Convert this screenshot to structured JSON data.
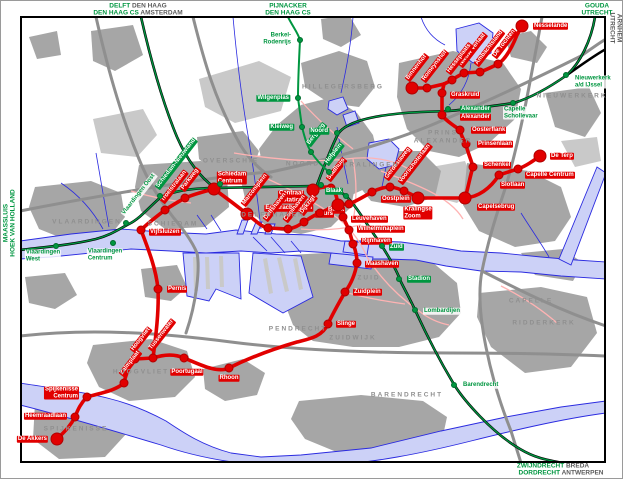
{
  "colors": {
    "metro_red": "#e10000",
    "rail_green": "#009640",
    "water_fill": "#ccd1f7",
    "water_line": "#2a2ae0",
    "motorway": "#8f8f8f",
    "urban": "#a6a6a6",
    "urban_light": "#c6c6c6",
    "tram_pink": "#ffb3b3",
    "area_text": "#8f8f8f",
    "edge_dark": "#5a5a5a"
  },
  "legend": {
    "metro_station": "metro-station",
    "rail_station": "rail-station"
  },
  "edge_labels": [
    {
      "id": "dest-delft-denhaag",
      "x": 137,
      "y": 5,
      "anchor": "middle",
      "rot": 0,
      "segs": [
        {
          "t": "DELFT ",
          "c": "g"
        },
        {
          "t": "DEN HAAG",
          "c": "d"
        }
      ]
    },
    {
      "id": "dest-denhaagcs-amsterdam",
      "x": 137,
      "y": 12,
      "anchor": "middle",
      "rot": 0,
      "segs": [
        {
          "t": "DEN HAAG CS ",
          "c": "g"
        },
        {
          "t": "AMSTERDAM",
          "c": "d"
        }
      ]
    },
    {
      "id": "dest-pijnacker",
      "x": 287,
      "y": 5,
      "anchor": "middle",
      "rot": 0,
      "segs": [
        {
          "t": "PIJNACKER",
          "c": "g"
        }
      ]
    },
    {
      "id": "dest-denhaagcs",
      "x": 287,
      "y": 12,
      "anchor": "middle",
      "rot": 0,
      "segs": [
        {
          "t": "DEN HAAG CS",
          "c": "g"
        }
      ]
    },
    {
      "id": "dest-gouda",
      "x": 596,
      "y": 5,
      "anchor": "middle",
      "rot": 0,
      "segs": [
        {
          "t": "GOUDA",
          "c": "g"
        }
      ]
    },
    {
      "id": "dest-utrecht-top",
      "x": 596,
      "y": 12,
      "anchor": "middle",
      "rot": 0,
      "segs": [
        {
          "t": "UTRECHT",
          "c": "g"
        }
      ]
    },
    {
      "id": "dest-utrecht-right",
      "x": 611,
      "y": 27,
      "anchor": "middle",
      "rot": 90,
      "segs": [
        {
          "t": "UTRECHT",
          "c": "d"
        }
      ]
    },
    {
      "id": "dest-arnhem-right",
      "x": 618,
      "y": 27,
      "anchor": "middle",
      "rot": 90,
      "segs": [
        {
          "t": "ARNHEM",
          "c": "d"
        }
      ]
    },
    {
      "id": "dest-maassluis",
      "x": 5,
      "y": 222,
      "anchor": "middle",
      "rot": -90,
      "segs": [
        {
          "t": "MAASSLUIS",
          "c": "g"
        }
      ]
    },
    {
      "id": "dest-hoekvanholland",
      "x": 12,
      "y": 222,
      "anchor": "middle",
      "rot": -90,
      "segs": [
        {
          "t": "HOEK VAN HOLLAND",
          "c": "g"
        }
      ]
    },
    {
      "id": "dest-zwijndrecht-breda",
      "x": 552,
      "y": 465,
      "anchor": "middle",
      "rot": 0,
      "segs": [
        {
          "t": "ZWIJNDRECHT ",
          "c": "g"
        },
        {
          "t": "BREDA",
          "c": "d"
        }
      ]
    },
    {
      "id": "dest-dordrecht-antwerpen",
      "x": 560,
      "y": 472,
      "anchor": "middle",
      "rot": 0,
      "segs": [
        {
          "t": "DORDRECHT ",
          "c": "g"
        },
        {
          "t": "ANTWERPEN",
          "c": "d"
        }
      ]
    }
  ],
  "areas": [
    {
      "name": "VLAARDINGEN",
      "x": 86,
      "y": 221
    },
    {
      "name": "SCHIEDAM",
      "x": 172,
      "y": 223
    },
    {
      "name": "OVERSCHIE",
      "x": 230,
      "y": 160
    },
    {
      "name": "NOORD",
      "x": 302,
      "y": 163
    },
    {
      "name": "HILLEGERSBERG",
      "x": 342,
      "y": 86
    },
    {
      "name": "KRALINGEN",
      "x": 370,
      "y": 164
    },
    {
      "name": "DELFSHAVEN",
      "x": 272,
      "y": 214
    },
    {
      "name": "PRINS\nALEXANDER",
      "x": 442,
      "y": 136
    },
    {
      "name": "NIEUWERKERK",
      "x": 571,
      "y": 95
    },
    {
      "name": "CAPELLE",
      "x": 530,
      "y": 300
    },
    {
      "name": "ZUID",
      "x": 368,
      "y": 277
    },
    {
      "name": "ZUIDWIJK",
      "x": 352,
      "y": 337
    },
    {
      "name": "PENDRECHT",
      "x": 297,
      "y": 328
    },
    {
      "name": "RIDDERKERK",
      "x": 543,
      "y": 322
    },
    {
      "name": "BARENDRECHT",
      "x": 406,
      "y": 394
    },
    {
      "name": "HOOGVLIET",
      "x": 140,
      "y": 371
    },
    {
      "name": "SPIJKENISSE",
      "x": 75,
      "y": 428
    }
  ],
  "metro_stations": [
    {
      "n": "Nesselande",
      "x": 521,
      "y": 25,
      "big": true,
      "lx": 532,
      "ly": 25,
      "a": "start"
    },
    {
      "n": "De Tochten",
      "x": 497,
      "y": 63,
      "lx": 493,
      "ly": 56,
      "a": "diag"
    },
    {
      "n": "Ambachtsland",
      "x": 479,
      "y": 71,
      "lx": 475,
      "ly": 64,
      "a": "diag"
    },
    {
      "n": "Nieuw Verlaat",
      "x": 463,
      "y": 72,
      "lx": 459,
      "ly": 65,
      "a": "diag"
    },
    {
      "n": "Hesseplaats",
      "x": 451,
      "y": 79,
      "lx": 447,
      "ly": 72,
      "a": "diag"
    },
    {
      "n": "Romeynshof",
      "x": 426,
      "y": 87,
      "lx": 422,
      "ly": 80,
      "a": "diag"
    },
    {
      "n": "Binnenhof",
      "x": 411,
      "y": 87,
      "big": true,
      "lx": 406,
      "ly": 79,
      "a": "diag"
    },
    {
      "n": "Graskruid",
      "x": 441,
      "y": 92,
      "lx": 449,
      "ly": 94,
      "a": "start"
    },
    {
      "n": "Alexander",
      "x": 441,
      "y": 114,
      "lx": 459,
      "ly": 116,
      "a": "start"
    },
    {
      "n": "Oosterflank",
      "x": 459,
      "y": 129,
      "lx": 470,
      "ly": 129,
      "a": "start"
    },
    {
      "n": "Prinsenlaan",
      "x": 465,
      "y": 143,
      "lx": 476,
      "ly": 143,
      "a": "start"
    },
    {
      "n": "Schenkel",
      "x": 472,
      "y": 166,
      "lx": 482,
      "ly": 164,
      "a": "start"
    },
    {
      "n": "Capelsebrug",
      "x": 464,
      "y": 197,
      "big": true,
      "lx": 476,
      "ly": 206,
      "a": "start"
    },
    {
      "n": "Slotlaan",
      "x": 498,
      "y": 174,
      "lx": 499,
      "ly": 184,
      "a": "start"
    },
    {
      "n": "Capelle Centrum",
      "x": 517,
      "y": 168,
      "lx": 524,
      "ly": 174,
      "a": "start"
    },
    {
      "n": "De Terp",
      "x": 539,
      "y": 155,
      "big": true,
      "lx": 549,
      "ly": 155,
      "a": "start"
    },
    {
      "n": "Kralingse\nZoom",
      "x": 417,
      "y": 197,
      "big": true,
      "lx": 417,
      "ly": 212,
      "a": "middle"
    },
    {
      "n": "Voorschoterlaan",
      "x": 403,
      "y": 190,
      "lx": 399,
      "ly": 182,
      "a": "diag"
    },
    {
      "n": "Gerdesiaweg",
      "x": 389,
      "y": 186,
      "lx": 385,
      "ly": 178,
      "a": "diag"
    },
    {
      "n": "Oostplein",
      "x": 371,
      "y": 191,
      "lx": 380,
      "ly": 198,
      "a": "start"
    },
    {
      "n": "Blaak",
      "x": 348,
      "y": 203,
      "lx": 344,
      "ly": 209,
      "a": "end"
    },
    {
      "n": "Beurs",
      "x": 337,
      "y": 204,
      "big": true,
      "lx": 333,
      "ly": 213,
      "a": "end"
    },
    {
      "n": "Stadhuis",
      "x": 330,
      "y": 187,
      "lx": 327,
      "ly": 179,
      "a": "diag"
    },
    {
      "n": "Centraal\nStation",
      "x": 312,
      "y": 189,
      "big": true,
      "lx": 303,
      "ly": 196,
      "a": "end",
      "align": "right"
    },
    {
      "n": "Eendrachtsplein",
      "x": 319,
      "y": 212,
      "lx": 312,
      "ly": 207,
      "a": "end"
    },
    {
      "n": "Dijkzigt",
      "x": 303,
      "y": 221,
      "lx": 300,
      "ly": 213,
      "a": "diag"
    },
    {
      "n": "Coolhaven",
      "x": 287,
      "y": 228,
      "lx": 284,
      "ly": 220,
      "a": "diag"
    },
    {
      "n": "Delfshaven",
      "x": 267,
      "y": 227,
      "lx": 264,
      "ly": 219,
      "a": "diag"
    },
    {
      "n": "Marconiplein",
      "x": 246,
      "y": 213,
      "big": true,
      "lx": 242,
      "ly": 204,
      "a": "diag"
    },
    {
      "n": "Leuvehaven",
      "x": 342,
      "y": 216,
      "lx": 350,
      "ly": 218,
      "a": "start"
    },
    {
      "n": "Wilhelminaplein",
      "x": 348,
      "y": 229,
      "lx": 356,
      "ly": 228,
      "a": "start"
    },
    {
      "n": "Rijnhaven",
      "x": 352,
      "y": 243,
      "lx": 360,
      "ly": 240,
      "a": "start"
    },
    {
      "n": "Maashaven",
      "x": 356,
      "y": 262,
      "lx": 364,
      "ly": 263,
      "a": "start"
    },
    {
      "n": "Zuidplein",
      "x": 344,
      "y": 291,
      "lx": 352,
      "ly": 291,
      "a": "start"
    },
    {
      "n": "Slinge",
      "x": 327,
      "y": 323,
      "lx": 335,
      "ly": 323,
      "a": "start"
    },
    {
      "n": "Rhoon",
      "x": 228,
      "y": 367,
      "lx": 228,
      "ly": 377,
      "a": "middle"
    },
    {
      "n": "Poortugaal",
      "x": 183,
      "y": 357,
      "lx": 186,
      "ly": 371,
      "a": "middle"
    },
    {
      "n": "Tussenwater",
      "x": 152,
      "y": 357,
      "lx": 149,
      "ly": 349,
      "a": "diag"
    },
    {
      "n": "Hoogvliet",
      "x": 134,
      "y": 358,
      "lx": 131,
      "ly": 350,
      "a": "diag"
    },
    {
      "n": "Zalmplaat",
      "x": 123,
      "y": 382,
      "lx": 120,
      "ly": 374,
      "a": "diag"
    },
    {
      "n": "Spijkenisse\nCentrum",
      "x": 86,
      "y": 396,
      "lx": 78,
      "ly": 392,
      "a": "end",
      "align": "right"
    },
    {
      "n": "Heemraadlaan",
      "x": 74,
      "y": 416,
      "lx": 66,
      "ly": 415,
      "a": "end"
    },
    {
      "n": "De Akkers",
      "x": 56,
      "y": 438,
      "big": true,
      "lx": 47,
      "ly": 438,
      "a": "end"
    },
    {
      "n": "Pernis",
      "x": 157,
      "y": 288,
      "lx": 166,
      "ly": 288,
      "a": "start"
    },
    {
      "n": "Vijfsluizen",
      "x": 140,
      "y": 229,
      "lx": 148,
      "ly": 231,
      "a": "start"
    },
    {
      "n": "Troelstralaan",
      "x": 164,
      "y": 209,
      "lx": 161,
      "ly": 201,
      "a": "diag"
    },
    {
      "n": "Parkweg",
      "x": 184,
      "y": 197,
      "lx": 181,
      "ly": 189,
      "a": "diag"
    },
    {
      "n": "Schiedam\nCentrum",
      "x": 213,
      "y": 188,
      "big": true,
      "lx": 231,
      "ly": 177,
      "a": "middle"
    }
  ],
  "rail_stations": [
    {
      "n": "Berkel-\nRodenrijs",
      "x": 299,
      "y": 39,
      "style": "greentext",
      "lx": 291,
      "ly": 38,
      "a": "end",
      "align": "right"
    },
    {
      "n": "Wilgenplas",
      "x": 297,
      "y": 97,
      "style": "greenfill",
      "lx": 289,
      "ly": 97,
      "a": "end"
    },
    {
      "n": "Kleiweg",
      "x": 301,
      "y": 126,
      "style": "greenfill",
      "lx": 293,
      "ly": 126,
      "a": "end"
    },
    {
      "n": "Bergweg",
      "x": 310,
      "y": 151,
      "style": "greenfill",
      "lx": 307,
      "ly": 144,
      "a": "diag"
    },
    {
      "n": "Hofplein",
      "x": 328,
      "y": 171,
      "style": "greenfill",
      "lx": 325,
      "ly": 163,
      "a": "diag"
    },
    {
      "n": "Noord",
      "x": 336,
      "y": 132,
      "style": "greenfill",
      "lx": 328,
      "ly": 130,
      "a": "end"
    },
    {
      "n": "Blaak",
      "x": 345,
      "y": 195,
      "style": "greenfill",
      "lx": 342,
      "ly": 190,
      "a": "end"
    },
    {
      "n": "Zuid",
      "x": 381,
      "y": 245,
      "style": "greenfill",
      "lx": 388,
      "ly": 246,
      "a": "start"
    },
    {
      "n": "Stadion",
      "x": 398,
      "y": 278,
      "style": "greenfill",
      "lx": 406,
      "ly": 278,
      "a": "start"
    },
    {
      "n": "Lombardijen",
      "x": 414,
      "y": 309,
      "style": "greentext",
      "lx": 422,
      "ly": 310,
      "a": "start"
    },
    {
      "n": "Barendrecht",
      "x": 453,
      "y": 384,
      "style": "greentext",
      "lx": 461,
      "ly": 384,
      "a": "start"
    },
    {
      "n": "Alexander",
      "x": 447,
      "y": 108,
      "style": "greenfill",
      "lx": 459,
      "ly": 108,
      "a": "start"
    },
    {
      "n": "Capelle\nSchollevaar",
      "x": 512,
      "y": 102,
      "style": "greentext",
      "lx": 502,
      "ly": 112,
      "a": "start"
    },
    {
      "n": "Nieuwerkerk\na/d IJssel",
      "x": 565,
      "y": 74,
      "style": "greentext",
      "lx": 573,
      "ly": 81,
      "a": "start"
    },
    {
      "n": "Schiedam-Nieuwland",
      "x": 159,
      "y": 195,
      "style": "greenfill",
      "lx": 156,
      "ly": 187,
      "a": "diag"
    },
    {
      "n": "Vlaardingen Oost",
      "x": 125,
      "y": 222,
      "style": "greentext",
      "lx": 122,
      "ly": 214,
      "a": "diag"
    },
    {
      "n": "Vlaardingen\nCentrum",
      "x": 112,
      "y": 242,
      "style": "greentext",
      "lx": 104,
      "ly": 254,
      "a": "middle"
    },
    {
      "n": "Vlaardingen\nWest",
      "x": 55,
      "y": 245,
      "style": "greentext",
      "lx": 42,
      "ly": 255,
      "a": "middle"
    },
    {
      "n": "",
      "x": 320,
      "y": 184,
      "style": "greenfill",
      "lx": 0,
      "ly": 0,
      "a": "none"
    },
    {
      "n": "",
      "x": 219,
      "y": 183,
      "style": "greenfill",
      "lx": 0,
      "ly": 0,
      "a": "none"
    }
  ]
}
